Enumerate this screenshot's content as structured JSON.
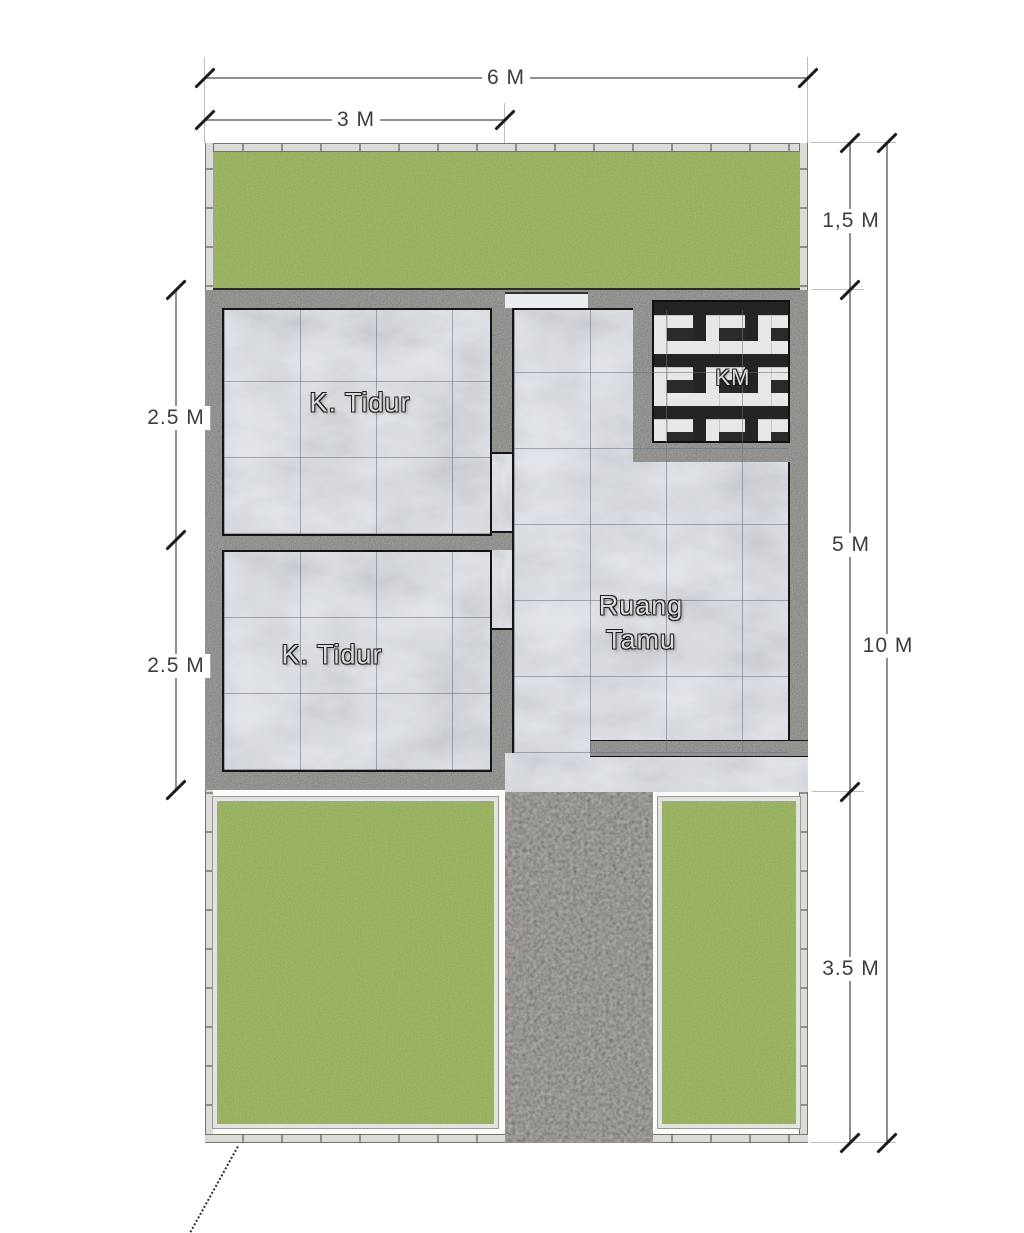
{
  "plan": {
    "title": "house-floor-plan"
  },
  "rooms": {
    "bedroom_top": {
      "label": "K. Tidur"
    },
    "bedroom_bottom": {
      "label": "K. Tidur"
    },
    "living_room": {
      "label_line1": "Ruang",
      "label_line2": "Tamu"
    },
    "bathroom": {
      "label": "KM"
    }
  },
  "dimensions": {
    "top_total": "6 M",
    "top_partial": "3 M",
    "right_back_garden": "1,5 M",
    "right_house": "5 M",
    "right_front_yard": "3.5 M",
    "right_total": "10 M",
    "left_bedroom_top": "2.5 M",
    "left_bedroom_bottom": "2.5 M"
  },
  "colors": {
    "grass": "#8dae3d",
    "wall": "#6b6862",
    "path_gravel": "#6a645c",
    "marble": "#e3e7ed",
    "bath_tile_black": "#242424",
    "bath_tile_white": "#e7e7e5",
    "fence": "#dbdbd7",
    "dimension_line": "#8f8f8f",
    "dimension_text": "#3d3d3d"
  }
}
